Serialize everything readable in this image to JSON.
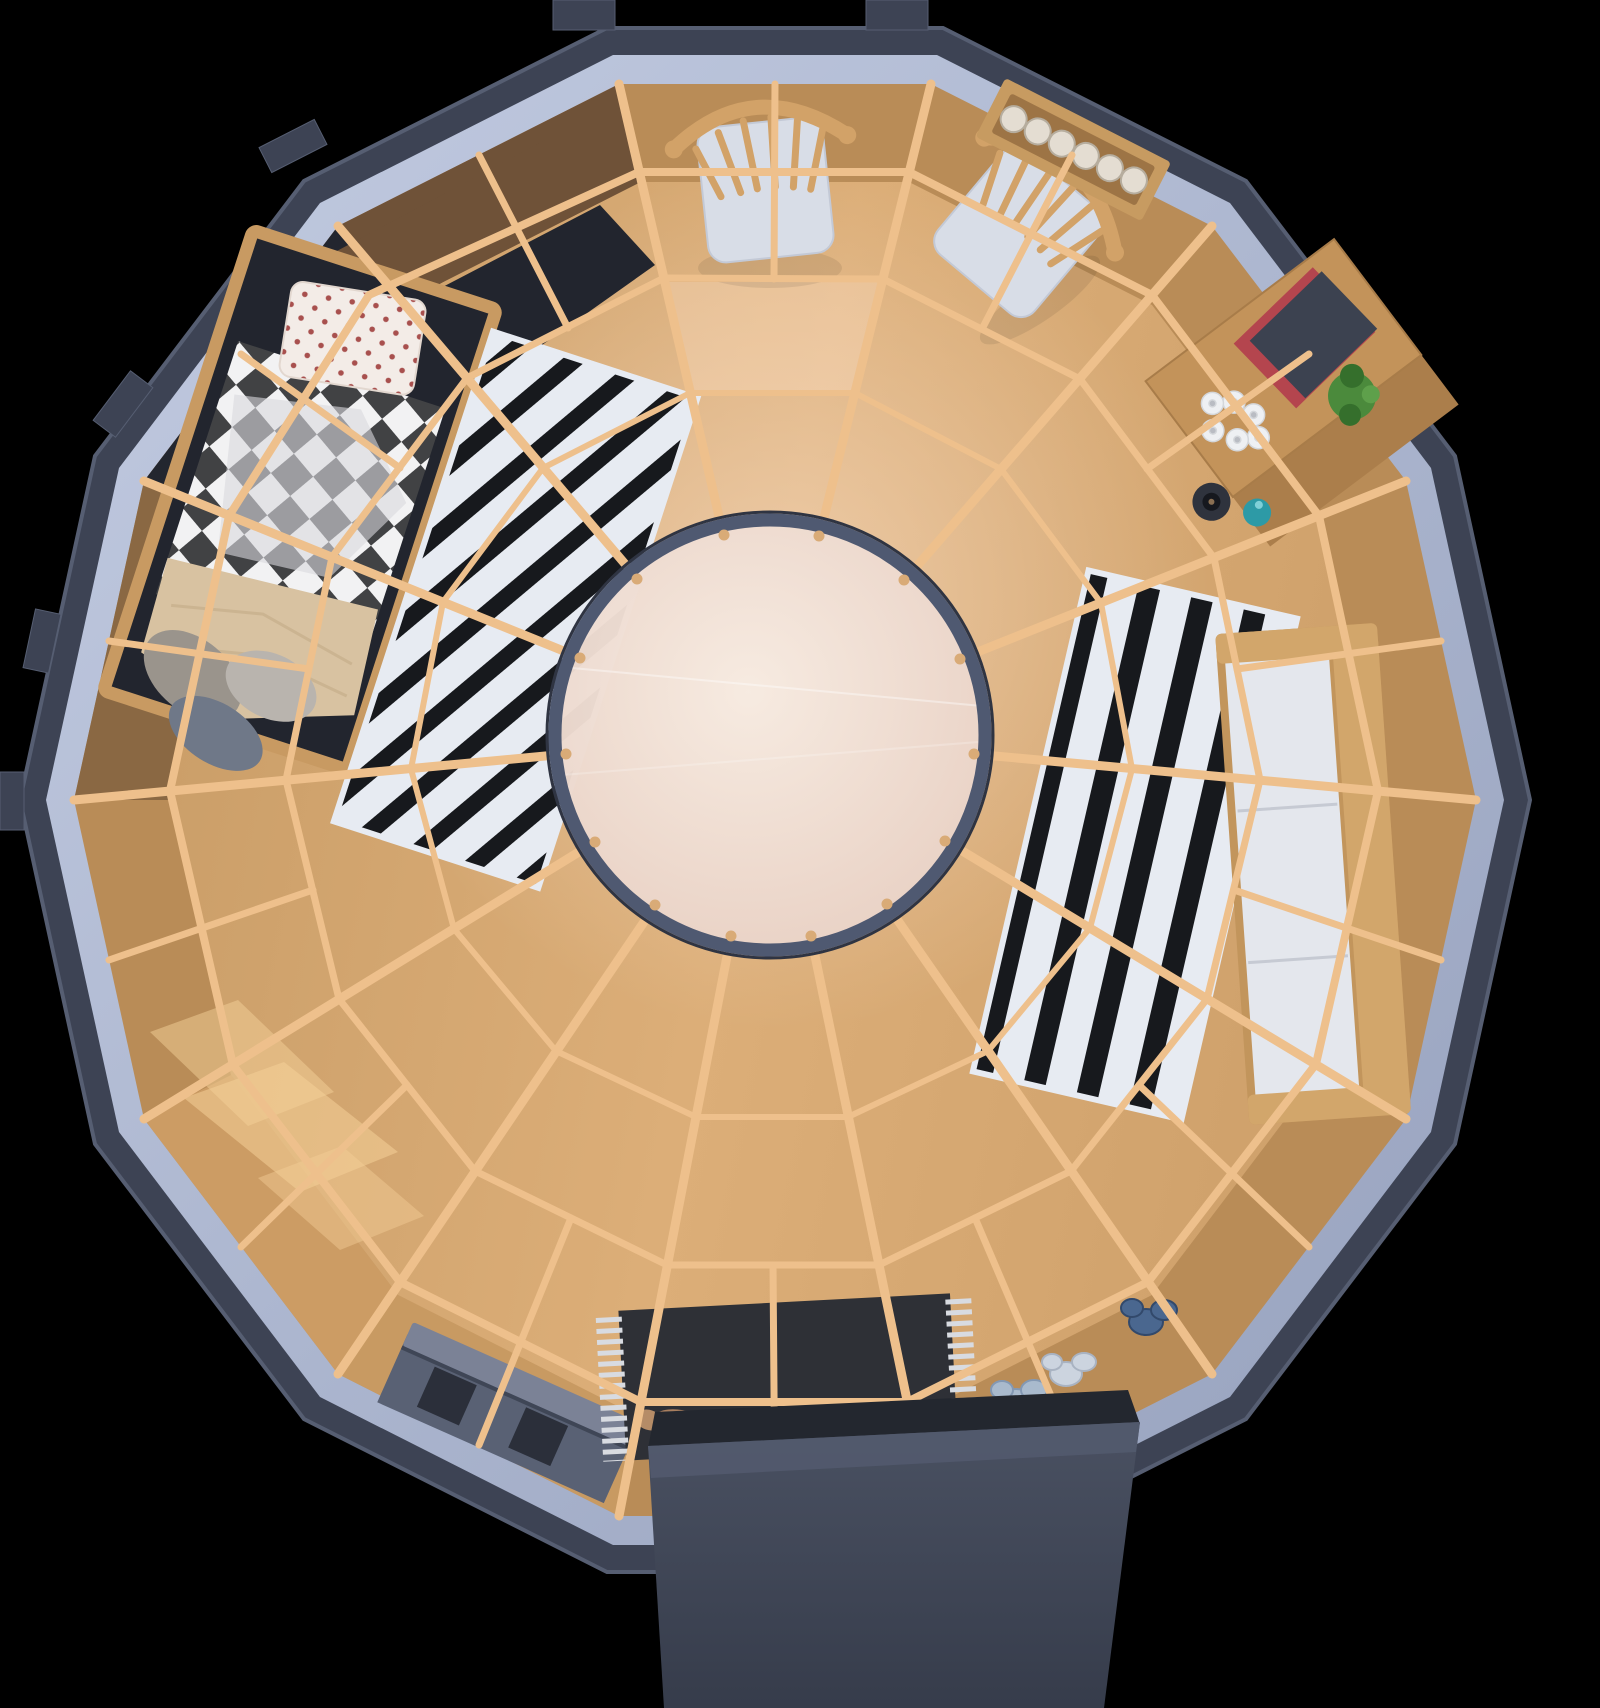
{
  "meta": {
    "view": "top-down-3d-render",
    "structure": "round-cabin-floorplan"
  },
  "objects": {
    "shell": "dark polygonal cabin shell",
    "band": "wall top rim",
    "wall": "interior wall ring",
    "floor": "wood floor",
    "web": "radial roof beam lattice",
    "skylight": "central skylight dome",
    "bed": "bed with checkered duvet",
    "wardrobe": "wood wall panel by bed",
    "rugLeft": "black and white striped rug",
    "rugRight": "black and white striped rug",
    "chairA": "wooden chair with white cushion",
    "chairB": "wooden chair with white cushion",
    "cupShelf": "wall shelf with glasses",
    "desk": "desk with book plant and decor",
    "sofa": "bench sofa with white cushion",
    "console": "gray low cabinet",
    "mat": "dark entry doormat with fringe",
    "slippers": "slippers on doormat",
    "shoes": "shoes by entrance wall",
    "porch": "entrance porch"
  },
  "colors": {
    "bg": "#000000",
    "shell": "#3d4354",
    "shellEdge": "#565e72",
    "band1": "#c3cce2",
    "band2": "#96a1bd",
    "wallWood": "#b98c57",
    "wallWoodLight": "#cf9f66",
    "wallNavy": "#23262f",
    "wallBrown": "#8a6843",
    "panelBrown": "#6f5238",
    "floorA": "#c89c66",
    "floorB": "#dcae78",
    "floorC": "#d0a26c",
    "sun": "#f4cf97",
    "glow": "#ffe9d8",
    "brightQuad": "#ffdfc2",
    "beam": "#eec08c",
    "sky1": "#f7ece3",
    "sky2": "#e7cec2",
    "skyRim": "#4f5971",
    "skyRimOuter": "#2f3442",
    "peg": "#d9ab77",
    "seam": "#ffffff",
    "bedFrame": "#c89a62",
    "bedInner": "#22252e",
    "checkDark": "#414244",
    "checkLight": "#f2f2f3",
    "sheet": "#d9d9dd",
    "pillow": "#f3ece7",
    "dot": "#a8504e",
    "pillowEdge": "#e2d7cf",
    "blanket": "#d8c2a1",
    "blanketFold": "#c6ae8a",
    "cushA": "#9a948c",
    "cushB": "#6f7888",
    "cushC": "#b9b4ae",
    "rugWhite": "#e7ebf2",
    "rugBlack": "#17191d",
    "chairWood": "#d2a268",
    "chairCushion": "#d8dde7",
    "chairCushionEdge": "#c3c9d6",
    "shelfWood": "#c79b61",
    "shelfInner": "#9d7445",
    "glass": "#e4ddd2",
    "glassRim": "#b6ad9e",
    "glassIn": "#cfc7b8",
    "deskWood": "#c3935a",
    "deskEdge": "#a87c49",
    "deskShelf": "#ab7e4b",
    "bookCover": "#3c4250",
    "bookRed": "#b4454e",
    "plant": "#4b8a3c",
    "plantDark": "#356f2c",
    "plantLight": "#5ea04b",
    "sculpture": "#eef0f3",
    "sculptureEdge": "#d4d7db",
    "sculptureDot": "#b9bcc3",
    "teal": "#2d9aa6",
    "tealHi": "#7fd0d8",
    "bowl": "#2f333d",
    "bowlInner": "#16181e",
    "bowlDot": "#8a6f52",
    "sofaWood": "#c2955c",
    "sofaWoodLight": "#d2a66b",
    "sofaCushion": "#e4e7ed",
    "sofaSeam": "#c6cad3",
    "consoleBody": "#596174",
    "consoleTop": "#7b8296",
    "consoleSquare": "#2b2f3a",
    "consoleLine": "#3f4656",
    "mat": "#2e3036",
    "fringe": "#d8dbe1",
    "slipper": "#c8a183",
    "slipperEdge": "#a97f5f",
    "slipper2": "#b58c67",
    "porch1": "#4a5162",
    "porch2": "#363c4b",
    "porchLip": "#525a6e",
    "gapShadow": "#23272f",
    "shoeLight": "#a9bacd",
    "shoeLightEdge": "#8398b3",
    "shoeWhite": "#ccd4df",
    "shoeWhiteEdge": "#a9b3c2",
    "shoeDark": "#4a678f",
    "shoeDarkEdge": "#32496b",
    "shadow": "#000000"
  }
}
